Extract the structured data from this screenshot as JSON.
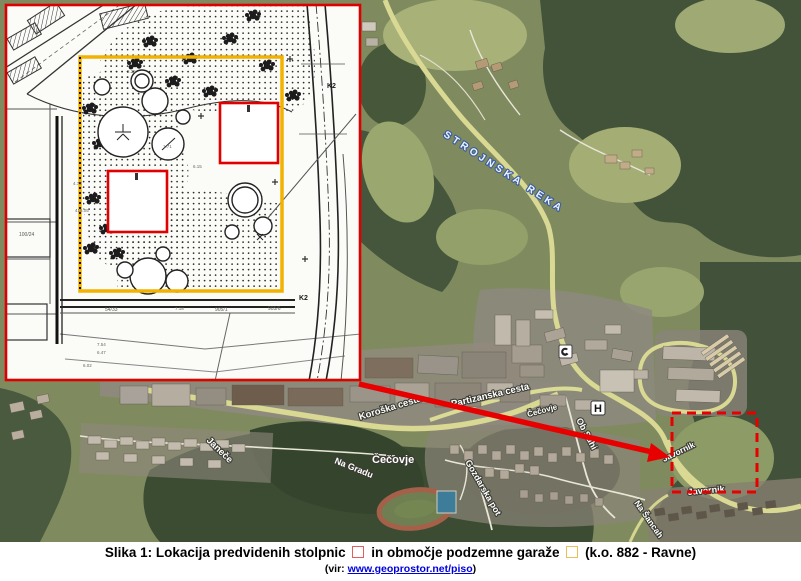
{
  "figure": {
    "caption_line1": {
      "prefix": "Slika 1: Lokacija predvidenih stolpnic",
      "mid": "in območje podzemne garaže",
      "suffix": "(k.o. 882 - Ravne)"
    },
    "caption_line2": {
      "prefix": "(vir:",
      "link": "www.geoprostor.net/piso",
      "suffix": ")"
    },
    "legend_colors": {
      "towers_outline": "#e06060",
      "garage_outline": "#e8c05a"
    }
  },
  "map": {
    "labels": {
      "river": "STROJNSKA REKA",
      "koroska": "Koroška cesta",
      "partizanska": "Partizanska cesta",
      "cecovje": "Čečovje",
      "cecovje_small": "Čečovje",
      "ob_suhi": "Ob Suhi",
      "gozdarska": "Gozdarska pot",
      "na_gradu": "Na Gradu",
      "janece": "Janeče",
      "javornik_near_arrow": "Javornik",
      "javornik_south": "Javornik",
      "na_sancah": "Na Šancah"
    },
    "markers": {
      "hospital": "H"
    },
    "overlay": {
      "accent_red": "#e80000"
    }
  },
  "inset": {
    "k2_upper": "K2",
    "k2_lower": "K2",
    "parcels": {
      "p1": "54/33",
      "p2": "905/1",
      "p3": "905/6",
      "p4": "100/24"
    },
    "dims": {
      "d1": "2.25",
      "d2": "1.71",
      "d3": "6.15",
      "d4": "4.73",
      "d5": "416.05",
      "d6": "7.18",
      "d7": "7.54",
      "d8": "6.47",
      "d9": "6.02"
    },
    "colors": {
      "frame": "#dd0000",
      "garage_outline": "#f2b200",
      "tower_outline": "#e10000"
    }
  }
}
